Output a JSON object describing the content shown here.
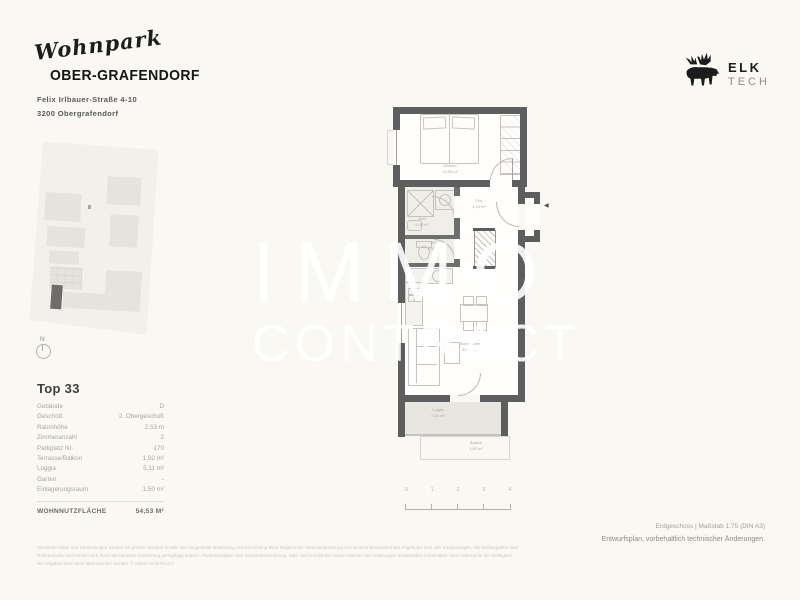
{
  "colors": {
    "background": "#FAF8F3",
    "wall": "#5E5E5E",
    "loggia_floor": "#E8E6E1",
    "watermark": "#FFFFFF",
    "logo_text": "#1D1D1D",
    "muted_text": "#A7A5A1"
  },
  "header": {
    "logo_script": "Wohnpark",
    "logo_name": "OBER-GRAFENDORF",
    "address_line1": "Felix Irlbauer-Straße 4-10",
    "address_line2": "3200 Obergrafendorf"
  },
  "brand": {
    "name": "ELK",
    "sub": "TECH"
  },
  "siteplan": {
    "north_label": "N"
  },
  "unit": {
    "title": "Top 33",
    "rows": [
      {
        "label": "Gebäude",
        "value": "D"
      },
      {
        "label": "Geschoß",
        "value": "2. Obergeschoß"
      },
      {
        "label": "Raumhöhe",
        "value": "2,53 m"
      },
      {
        "label": "Zimmeranzahl",
        "value": "2"
      },
      {
        "label": "Parkplatz Nr.",
        "value": "170"
      },
      {
        "label": "Terrasse/Balkon",
        "value": "1,92 m²"
      },
      {
        "label": "Loggia",
        "value": "5,11 m²"
      },
      {
        "label": "Garten",
        "value": "-"
      },
      {
        "label": "Einlagerungsraum",
        "value": "1,50 m²"
      }
    ],
    "total_label": "WOHNNUTZFLÄCHE",
    "total_value": "54,53 M²"
  },
  "floorplan": {
    "watermark": {
      "line1": "IMMO",
      "line2": "CONTRACT"
    },
    "rooms": {
      "zimmer": {
        "name": "Zimmer",
        "area": "13,95 m²"
      },
      "bad": {
        "name": "Bad",
        "area": "4,08 m²"
      },
      "wc": {
        "name": "WC",
        "area": "1,60 m²"
      },
      "flur": {
        "name": "Flur",
        "area": "4,43 m²"
      },
      "wohnkueche": {
        "name": "Wohnküche",
        "area": "30,47 m²"
      },
      "loggia": {
        "name": "Loggia",
        "area": "5,11 m²"
      },
      "balkon": {
        "name": "Balkon",
        "area": "1,92 m²"
      }
    },
    "scalebar": {
      "ticks": [
        "0",
        "1",
        "2",
        "3",
        "4"
      ]
    },
    "entry_arrow": "◀"
  },
  "footer": {
    "plan_info": "Erdgeschoss | Maßstab 1:75 (DIN A3)",
    "note": "Entwurfsplan, vorbehaltlich technischer Änderungen.",
    "disclaimer": [
      "Sämtliche Pläne und Darstellungen wurden mit größter Sorgfalt erstellt. Die dargestellte Möblierung und Einrichtung dient lediglich der Veranschaulichung und ist nicht Bestandteil des Angebotes bzw. des Kaufvertrages. Alle Maßangaben sind",
      "Rohbaumaße und können sich durch die bauliche Ausführung geringfügig ändern. Flächenangaben laut Nutzwertberechnung. Satz- und Druckfehler sowie Irrtümer und Änderungen ausdrücklich vorbehalten. Eine Haftung für die Richtigkeit",
      "der Angaben kann nicht übernommen werden. © IMMO-CONTRACT"
    ]
  }
}
